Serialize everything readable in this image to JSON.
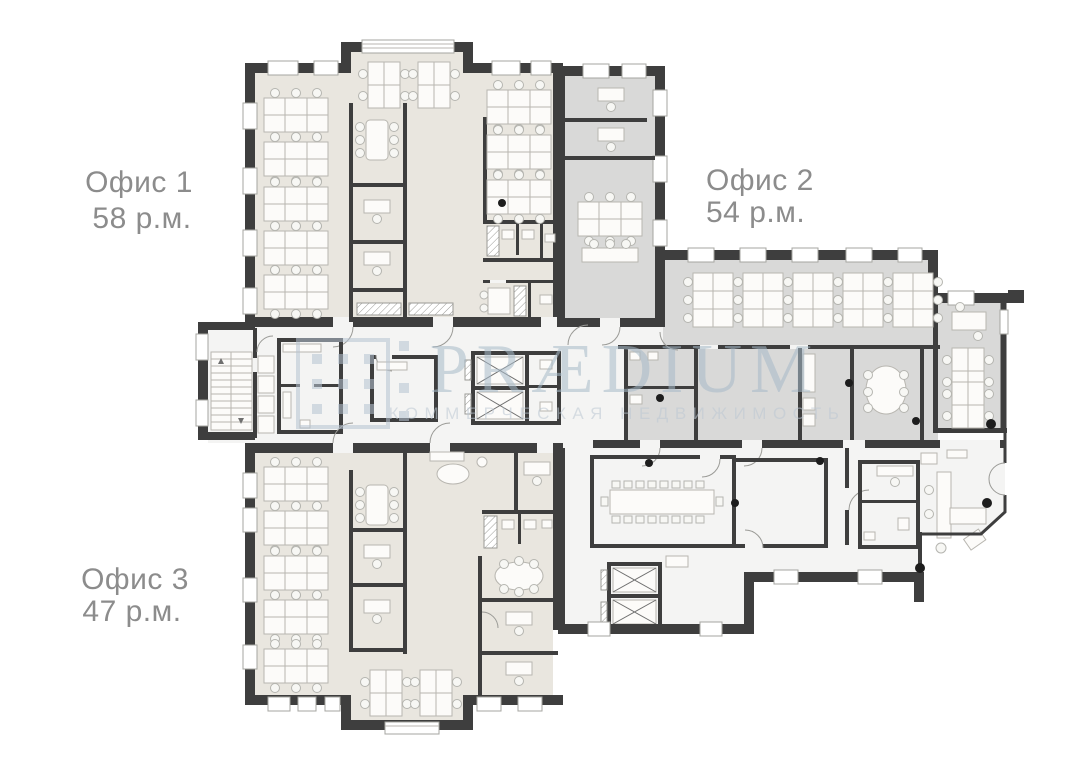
{
  "title": "Office floor plan",
  "offices": [
    {
      "id": "office-1",
      "name": "Офис 1",
      "area": "58 р.м.",
      "floor_color": "#e9e6df"
    },
    {
      "id": "office-2",
      "name": "Офис 2",
      "area": "54 р.м.",
      "floor_color": "#d9d9d8"
    },
    {
      "id": "office-3",
      "name": "Офис 3",
      "area": "47 р.м.",
      "floor_color": "#e9e6df"
    }
  ],
  "watermark": {
    "brand": "PRÆDIUM",
    "tagline": "КОММЕРЧЕСКАЯ НЕДВИЖИМОСТЬ",
    "color": "#a7bac9"
  },
  "plan": {
    "wall_color": "#3e3e3e",
    "common_floor_color": "#f4f4f3",
    "background": "#ffffff",
    "features": [
      "open-workspace",
      "meeting-rooms",
      "stairs",
      "elevators",
      "conference-room",
      "wc",
      "reception"
    ]
  }
}
